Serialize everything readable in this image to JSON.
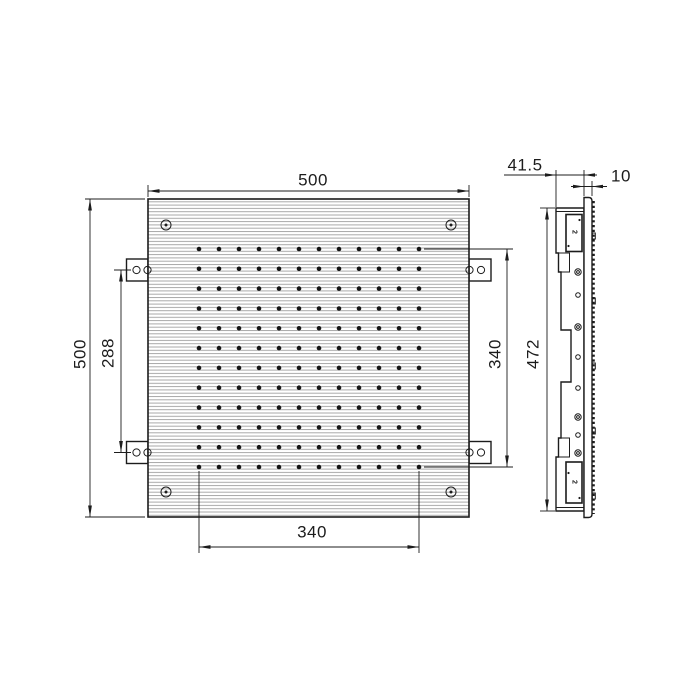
{
  "drawing": {
    "dimensions": {
      "front_width": "500",
      "front_height": "500",
      "bracket_spacing": "288",
      "nozzle_field_width": "340",
      "nozzle_field_height": "340",
      "body_height": "472",
      "mounting_depth": "41.5",
      "plate_thickness": "10"
    },
    "side_markings": {
      "top": "2",
      "bottom": "2"
    },
    "nozzle_grid": {
      "rows": 12,
      "cols": 12
    },
    "colors": {
      "line": "#1c1c1c",
      "hatch": "#a9a9a9",
      "dot": "#161616",
      "background": "#ffffff"
    }
  }
}
